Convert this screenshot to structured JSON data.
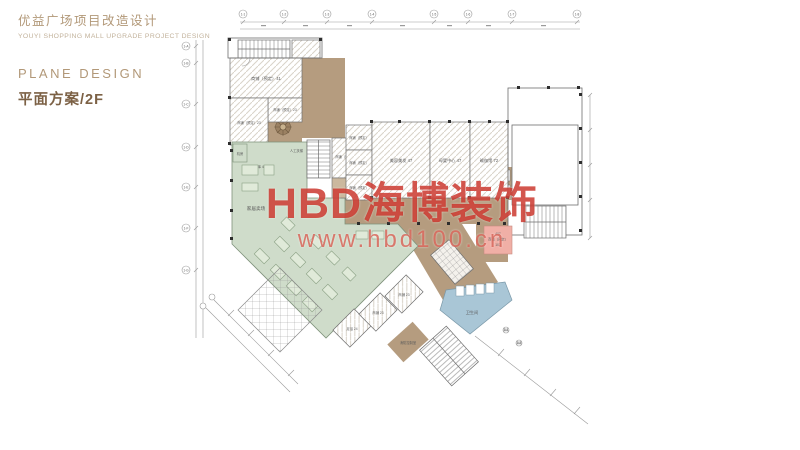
{
  "header": {
    "project_title_cn": "优益广场项目改造设计",
    "project_title_en": "YOUYI SHOPPING MALL UPGRADE PROJECT DESIGN",
    "section_title_en": "PLANE DESIGN",
    "section_title_cn": "平面方案/2F"
  },
  "watermark": {
    "brand": "HBD海博装饰",
    "website": "www.hbd100.cn"
  },
  "colors": {
    "corridor_tan": "#b59c7f",
    "retail_green": "#cfdcca",
    "water_blue": "#a9c6d6",
    "highlight_pink": "#f0afa6",
    "watermark_red": "#c6271c",
    "title_tan": "#b29878",
    "title_dark": "#7c6145"
  },
  "plan": {
    "rooms": {
      "machine": "机房",
      "storage": "仓库 42",
      "shop_a": "商铺（预定）41",
      "shop_b": "商铺（预定）23",
      "shop_c": "商铺（预定）23",
      "small1": "商铺（预定）",
      "small2": "商铺（预定）",
      "small3": "商铺（预定）",
      "shop26": "商铺（预定）26",
      "escalator": "人工扶梯",
      "beauty": "美容美发 47",
      "maternity": "母婴中心 47",
      "yoga": "瑜伽馆 72",
      "furniture": "家居卖场",
      "wc": "卫生间",
      "fire": "消防控制室",
      "pink_no": "407",
      "pink_name": "商铺（预定）",
      "pink_area": "103",
      "d1": "足浴 24",
      "d2": "商铺 23",
      "d3": "商铺 23"
    },
    "grid": {
      "top": [
        "1-1",
        "1-2",
        "1-3",
        "1-4",
        "1-5",
        "1-6",
        "1-7",
        "1-8"
      ],
      "left": [
        "1-A",
        "1-B",
        "1-C",
        "1-D",
        "1-E",
        "1-F",
        "1-G"
      ],
      "diag": [
        "2-1",
        "2-2"
      ]
    }
  }
}
